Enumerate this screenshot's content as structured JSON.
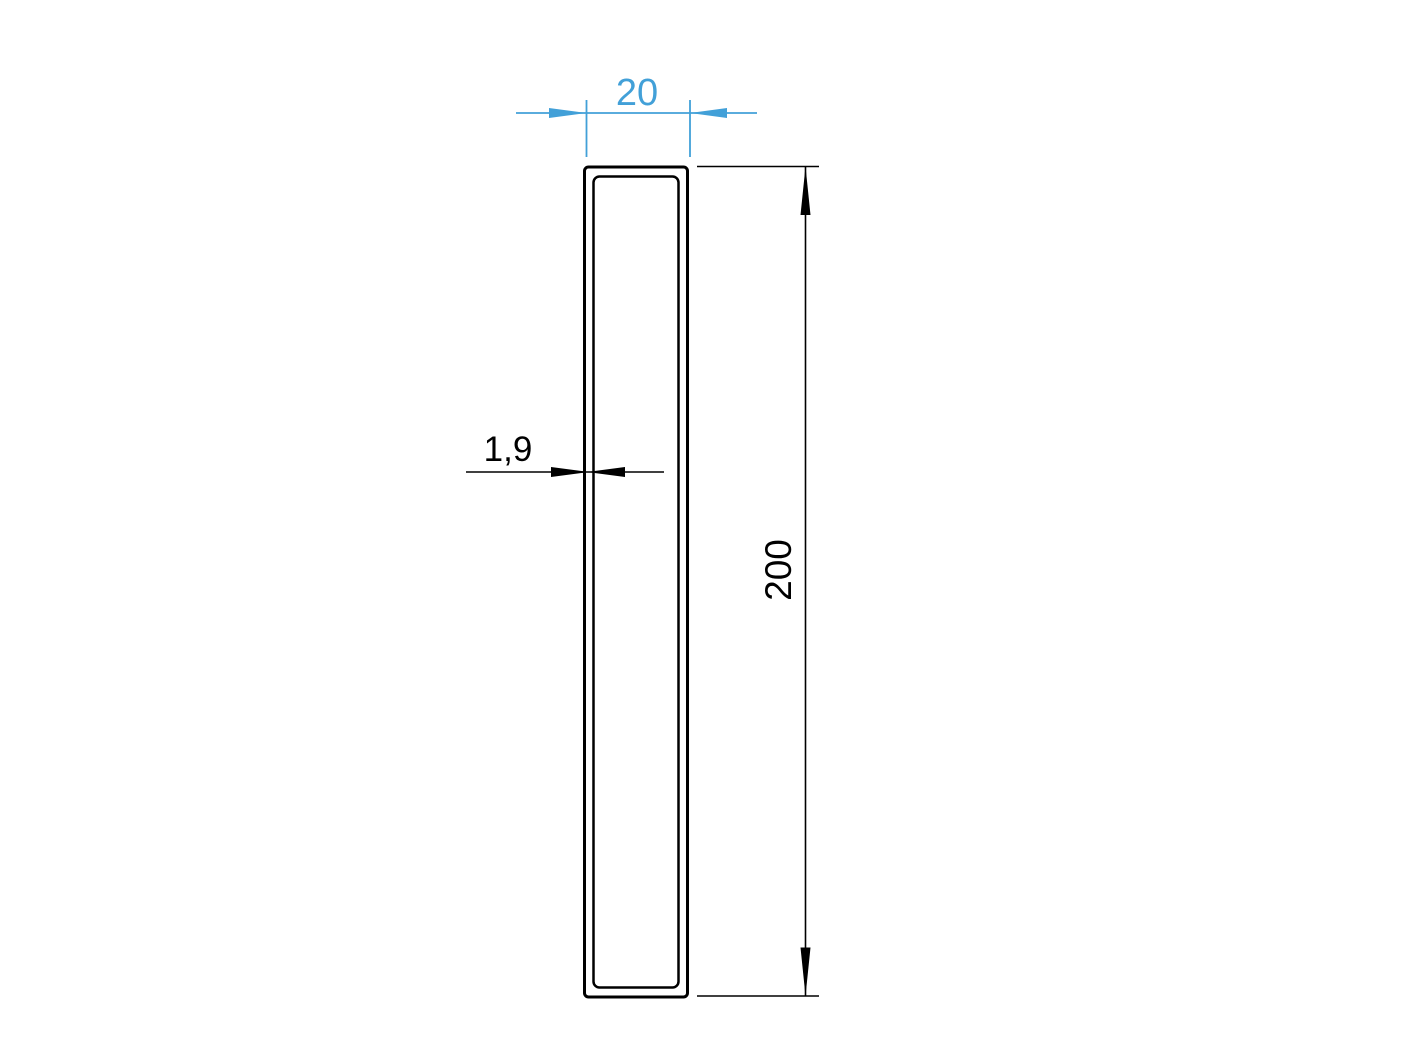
{
  "drawing": {
    "type": "technical-drawing",
    "subject": "rectangular-hollow-tube-cross-section",
    "dimensions": {
      "width": {
        "label": "20"
      },
      "wall_thickness": {
        "label": "1,9"
      },
      "height": {
        "label": "200"
      }
    },
    "colors": {
      "width_dimension_blue": "#42a0d8",
      "line_black": "#000000",
      "background": "#ffffff"
    }
  }
}
